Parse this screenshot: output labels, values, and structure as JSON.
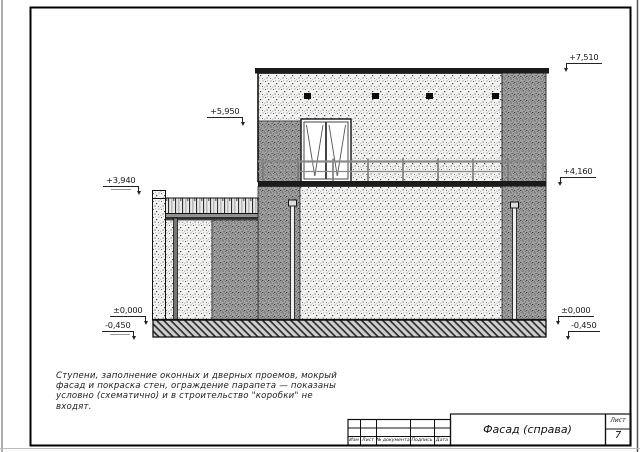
{
  "drawing": {
    "note_lines": [
      "Ступени, заполнение оконных и дверных проемов, мокрый",
      "фасад и покраска стен, ограждение парапета — показаны",
      "условно (схематично) и в строительство \"коробки\" не",
      "входят."
    ],
    "markers": [
      {
        "id": "plus-7510",
        "text": "+7,510"
      },
      {
        "id": "plus-5950",
        "text": "+5,950"
      },
      {
        "id": "plus-3940",
        "text": "+3,940"
      },
      {
        "id": "plus-4160",
        "text": "+4,160"
      },
      {
        "id": "zero-left",
        "text": "±0,000"
      },
      {
        "id": "zero-right",
        "text": "±0,000"
      },
      {
        "id": "minus-450-left",
        "text": "-0,450"
      },
      {
        "id": "minus-450-right",
        "text": "-0,450"
      }
    ],
    "colors": {
      "ink": "#111111",
      "wall_light": "#f3f3f1",
      "wall_dark": "#a3a3a3",
      "railing_gray": "#8a8a8a"
    }
  },
  "title_block": {
    "revision_columns": [
      "Изм",
      "Лист",
      "№ документа",
      "Подпись",
      "Дата"
    ],
    "title": "Фасад (справа)",
    "sheet_label": "Лист",
    "sheet_number": "7"
  }
}
